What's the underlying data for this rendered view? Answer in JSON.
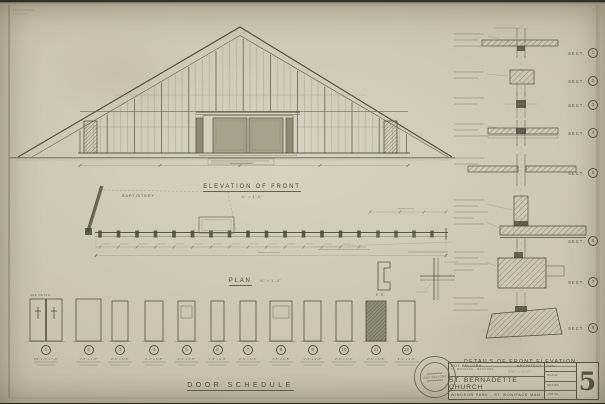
{
  "drawing_titles": {
    "elevation": {
      "title": "ELEVATION OF FRONT",
      "scale": "¼\" = 1'-0\""
    },
    "plan": {
      "title": "PLAN",
      "scale": "¼\" = 1'-0\""
    },
    "door_schedule": {
      "title": "DOOR SCHEDULE"
    },
    "details": {
      "title": "DETAILS OF FRONT ELEVATION",
      "scale": "1½\" = 1'-0\""
    }
  },
  "annotations": {
    "room_label": "BAPTISTERY",
    "full_size_label": "F.S.",
    "see_detail_note": "SEE DETAIL"
  },
  "sections": {
    "label": "SECT.",
    "items": [
      {
        "num": "1"
      },
      {
        "num": "2"
      },
      {
        "num": "3"
      },
      {
        "num": "4"
      },
      {
        "num": "5"
      },
      {
        "num": "6"
      },
      {
        "num": "7"
      },
      {
        "num": "8"
      }
    ]
  },
  "doors": {
    "items": [
      {
        "num": "1",
        "size": "PR. 2'-6\" x 7'-0\""
      },
      {
        "num": "2",
        "size": "3'-0\" x 7'-0\""
      },
      {
        "num": "3",
        "size": "2'-0\" x 6'-8\""
      },
      {
        "num": "4",
        "size": "2'-4\" x 6'-8\""
      },
      {
        "num": "5",
        "size": "2'-0\" x 6'-8\""
      },
      {
        "num": "6",
        "size": "1'-8\" x 6'-8\""
      },
      {
        "num": "7",
        "size": "2'-0\" x 6'-8\""
      },
      {
        "num": "8",
        "size": "2'-8\" x 6'-8\""
      },
      {
        "num": "9",
        "size": "2'-0\" x 6'-8\""
      },
      {
        "num": "10",
        "size": "2'-0\" x 6'-8\""
      },
      {
        "num": "11",
        "size": "2'-6\" x 6'-8\""
      },
      {
        "num": "12",
        "size": "2'-0\" x 6'-8\""
      }
    ]
  },
  "title_block": {
    "architect_name": "ROY SELLORS",
    "architect_title": "ARCHITECT",
    "architect_address": "ST. BONIFACE  ·  MANITOBA",
    "project": "ST. BERNADETTE CHURCH",
    "location": "WINDSOR PARK - ST. BONIFACE   MAN.",
    "sheet_number": "5",
    "fields": [
      {
        "label": "DATE"
      },
      {
        "label": "SCALE"
      },
      {
        "label": "DRAWN"
      },
      {
        "label": "JOB No."
      }
    ],
    "seal_text": "ROY SELLORS"
  },
  "colors": {
    "paper": "#ccc4b1",
    "ink": "#55503e",
    "ink_faint": "#8d8671"
  }
}
